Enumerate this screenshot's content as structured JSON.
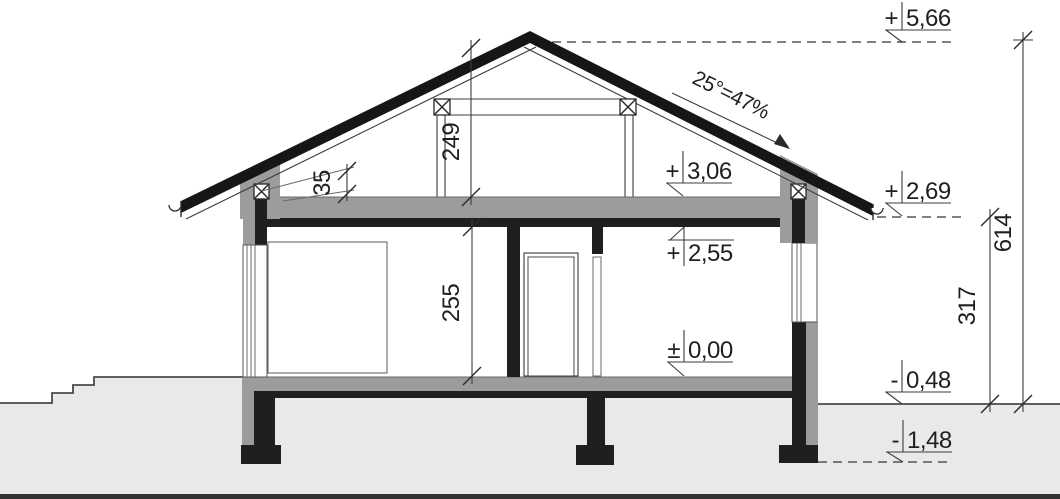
{
  "drawing": {
    "type": "house-cross-section",
    "roof_slope_label": "25°=47%"
  },
  "levels": {
    "ridge": {
      "sign": "+",
      "value": "5,66"
    },
    "ceiling_top": {
      "sign": "+",
      "value": "3,06"
    },
    "eave": {
      "sign": "+",
      "value": "2,69"
    },
    "ceiling_bottom": {
      "sign": "+",
      "value": "2,55"
    },
    "floor": {
      "sign": "±",
      "value": "0,00"
    },
    "ground": {
      "sign": "-",
      "value": "0,48"
    },
    "foundation_bottom": {
      "sign": "-",
      "value": "1,48"
    }
  },
  "dimensions": {
    "attic_clear_height": "249",
    "knee_wall_height": "35",
    "room_height": "255",
    "eave_above_ground": "317",
    "ridge_above_ground": "614"
  },
  "colors": {
    "section_dark": "#1f1f1f",
    "wall_gray": "#9c9c9c",
    "ground_fill": "#e9e9e9",
    "annotation_line": "#3c3c3c",
    "text": "#1f1f1f",
    "background": "#ffffff"
  }
}
